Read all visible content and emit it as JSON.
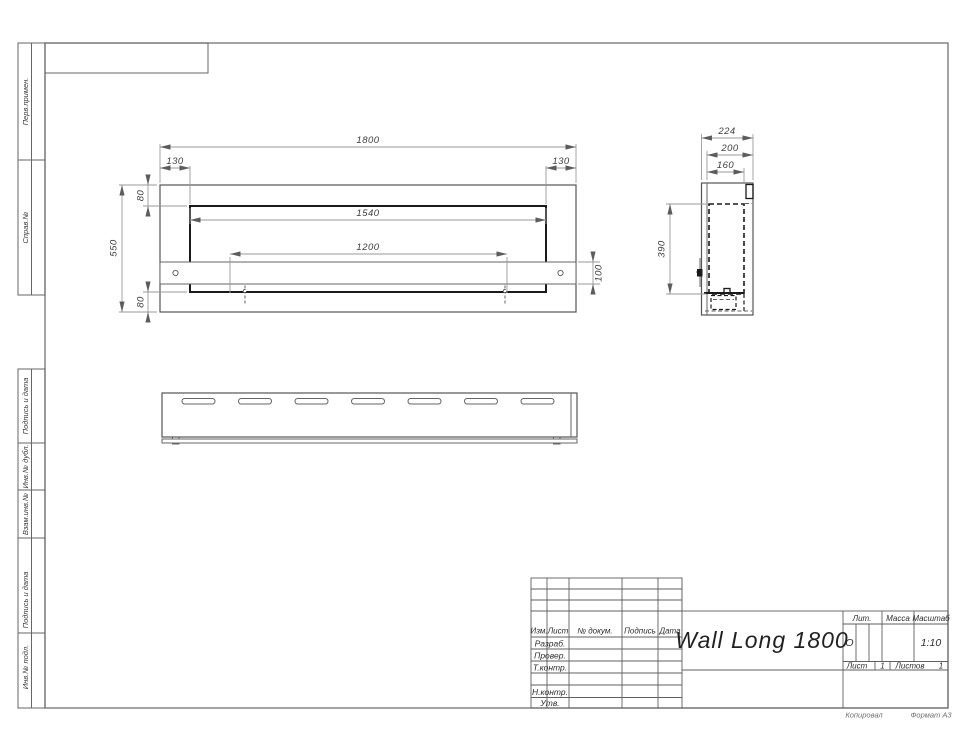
{
  "sheet": {
    "copy_note": "Копировал",
    "format_note": "Формат А3"
  },
  "margin_labels": {
    "perv_primen": "Перв.примен.",
    "sprav_no": "Справ.№",
    "podpis_data_1": "Подпись и дата",
    "inv_dubl": "Инв.№ дубл.",
    "vzam_inv": "Взам.инв.№",
    "podpis_data_2": "Подпись и дата",
    "inv_podl": "Инв.№ подл."
  },
  "title_block": {
    "col_izm": "Изм.",
    "col_list": "Лист",
    "col_doc": "№ докум.",
    "col_sign": "Подпись",
    "col_date": "Дата",
    "row_razrab": "Разраб.",
    "row_prover": "Провер.",
    "row_tkontr": "Т.контр.",
    "row_nkontr": "Н.контр.",
    "row_utv": "Утв.",
    "doc_title": "Wall Long 1800",
    "lit_label": "Лит.",
    "lit_value": "О",
    "mass_label": "Масса",
    "scale_label": "Масштаб",
    "scale_value": "1:10",
    "sheet_label": "Лист",
    "sheet_value": "1",
    "sheets_label": "Листов",
    "sheets_value": "1"
  },
  "front_view": {
    "dim_1800": "1800",
    "dim_130_left": "130",
    "dim_130_right": "130",
    "dim_550": "550",
    "dim_80_top": "80",
    "dim_80_bottom": "80",
    "dim_1540": "1540",
    "dim_1200": "1200",
    "dim_100": "100"
  },
  "side_view": {
    "dim_224": "224",
    "dim_200": "200",
    "dim_160": "160",
    "dim_390": "390"
  }
}
